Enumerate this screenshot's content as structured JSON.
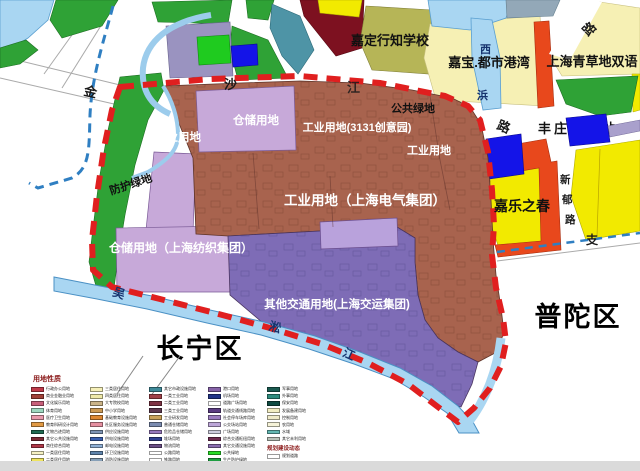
{
  "map": {
    "district_left": "长宁区",
    "district_right": "普陀区",
    "road_chars": {
      "jin": "金",
      "sha": "沙",
      "jiang": "江",
      "lu": "路",
      "lu_ne": "路",
      "zhi": "支",
      "xin": "新",
      "yu": "郁",
      "lu_xinyu": "路",
      "xi": "西",
      "bang": "浜"
    },
    "river_chars": {
      "wu": "吴",
      "song": "淞",
      "jiang": "江"
    },
    "zone_labels": {
      "industrial_w": "工业用地",
      "warehouse_n": "仓储用地",
      "industrial_3131": "工业用地(3131创意园)",
      "industrial_e": "工业用地",
      "industrial_electric": "工业用地（上海电气集团）",
      "warehouse_textile": "仓储用地（上海纺织集团）",
      "transport_other": "其他交通用地(上海交运集团)",
      "green_buffer": "防护绿地",
      "green_public": "公共绿地"
    },
    "pois": {
      "school_xingzhi": "嘉定行知学校",
      "jiabao": "嘉宝.都市港湾",
      "qingcaodi": "上海青草地双语",
      "gas_station": "丰庄加油站",
      "jiale": "嘉乐之春"
    }
  },
  "legend": {
    "title": "用地性质",
    "columns": [
      {
        "items": [
          {
            "label": "行政办公用地",
            "color": "#C03A4A"
          },
          {
            "label": "商业金融业用地",
            "color": "#A04038"
          },
          {
            "label": "文化娱乐用地",
            "color": "#C7607A"
          },
          {
            "label": "体育用地",
            "color": "#9ED8C0"
          },
          {
            "label": "医疗卫生用地",
            "color": "#E89AAC"
          },
          {
            "label": "教育科研设计用地",
            "color": "#E29A44"
          },
          {
            "label": "文物古迹用地",
            "color": "#206B52"
          },
          {
            "label": "其它公共设施用地",
            "color": "#7C2B36"
          },
          {
            "label": "商住综合用地",
            "color": "#B03848"
          },
          {
            "label": "一类居住用地",
            "color": "#F6F2C4"
          },
          {
            "label": "二类居住用地",
            "color": "#EFE45F"
          }
        ]
      },
      {
        "items": [
          {
            "label": "三类居住用地",
            "color": "#F6F0B8"
          },
          {
            "label": "四类居住用地",
            "color": "#EFE9A8"
          },
          {
            "label": "大专院校用地",
            "color": "#CBB488"
          },
          {
            "label": "中小学用地",
            "color": "#CC9A55"
          },
          {
            "label": "基础教育设施用地",
            "color": "#DD8833"
          },
          {
            "label": "社区服务设施用地",
            "color": "#E58FA0"
          },
          {
            "label": "供应设施用地",
            "color": "#7E94B5"
          },
          {
            "label": "供电设施用地",
            "color": "#3A5FB0"
          },
          {
            "label": "邮电设施用地",
            "color": "#8FB0D5"
          },
          {
            "label": "环卫设施用地",
            "color": "#5F85AD"
          },
          {
            "label": "消防设施用地",
            "color": "#87A0B8"
          }
        ]
      },
      {
        "items": [
          {
            "label": "其它市政设施用地",
            "color": "#3F8A99"
          },
          {
            "label": "一类工业用地",
            "color": "#A04048"
          },
          {
            "label": "二类工业用地",
            "color": "#7E3344"
          },
          {
            "label": "三类工业用地",
            "color": "#5E3A50"
          },
          {
            "label": "工业研发用地",
            "color": "#C9A35A"
          },
          {
            "label": "普通仓储用地",
            "color": "#7A8BB0"
          },
          {
            "label": "危险品仓储用地",
            "color": "#9678BC"
          },
          {
            "label": "堆场用地",
            "color": "#2F3F90"
          },
          {
            "label": "物流用地",
            "color": "#6A4E85"
          },
          {
            "label": "公路用地",
            "color": "#FFFFFF"
          },
          {
            "label": "铁路用地",
            "color": "#FFFFFF"
          }
        ]
      },
      {
        "items": [
          {
            "label": "港口用地",
            "color": "#8663A8"
          },
          {
            "label": "机场用地",
            "color": "#223488"
          },
          {
            "label": "道路广场用地",
            "color": "#FFFFFF"
          },
          {
            "label": "轨道交通线路用地",
            "color": "#5B3C82"
          },
          {
            "label": "社会停车场库用地",
            "color": "#9B7CC0"
          },
          {
            "label": "公交场站用地",
            "color": "#BCA6D8"
          },
          {
            "label": "广场用地",
            "color": "#CCCCDD"
          },
          {
            "label": "综合交通枢纽用地",
            "color": "#6E2C50"
          },
          {
            "label": "其它交通设施用地",
            "color": "#8A6CB0"
          },
          {
            "label": "公共绿地",
            "color": "#27DD27"
          },
          {
            "label": "生产防护绿地",
            "color": "#1F9E42"
          },
          {
            "label": "苗圃用地",
            "color": "#137055"
          }
        ]
      },
      {
        "items": [
          {
            "label": "军事用地",
            "color": "#1A5A50"
          },
          {
            "label": "外事用地",
            "color": "#2E8C7E"
          },
          {
            "label": "保安用地",
            "color": "#0F4A42"
          },
          {
            "label": "发展备建用地",
            "color": "#F2EDC2"
          },
          {
            "label": "控制用地",
            "color": "#EFEAC8"
          },
          {
            "label": "农用地",
            "color": "#F6F3D8"
          },
          {
            "label": "水域",
            "color": "#63B8B2"
          },
          {
            "label": "其它未利用地",
            "color": "#B9C2B9"
          }
        ]
      }
    ],
    "dynamics_title": "规划建设动态",
    "dynamics_items": [
      {
        "label": "规划道路",
        "color": "#FFFFFF"
      },
      {
        "label": "主体建成区",
        "color": "#DDDDDD"
      }
    ]
  },
  "colors": {
    "boundary_red": "#E01F1F",
    "boundary_blue_dash": "#2F7FC2",
    "water": "#A9D6F2",
    "industrial_brown": "#A8634E",
    "transport_purple": "#7E6CB6",
    "warehouse_lavender": "#C7A9D9",
    "green": "#2FA236",
    "public_green_bright": "#1FCB1F",
    "yellow_parcel": "#F2EA00",
    "pale_yellow": "#F6F0B4",
    "orange_red": "#E8481C",
    "blue_parcel": "#1414E8",
    "olive_school": "#B6B557",
    "maroon": "#7D1120",
    "teal": "#4E94A6"
  }
}
